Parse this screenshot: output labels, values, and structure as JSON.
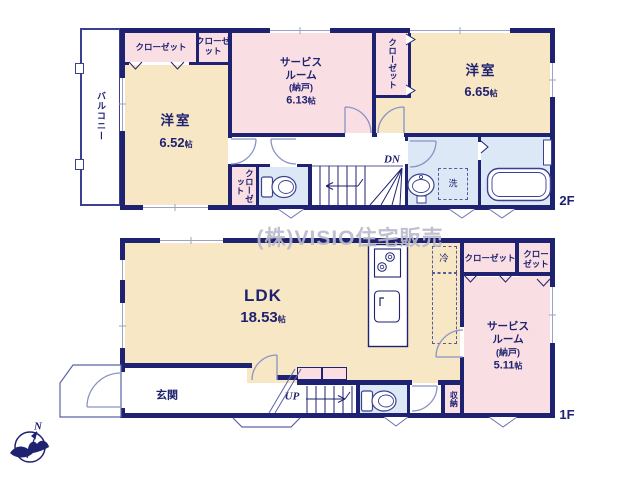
{
  "watermark": "(株)VISIO住宅販売",
  "compass": {
    "north": "N"
  },
  "colors": {
    "wall": "#1f2270",
    "room_yellow": "#f7e7c5",
    "room_pink": "#f9dfe3",
    "wet_area_blue": "#dce8f5",
    "door_arc": "#8a93c4",
    "watermark_gray": "#b8bacb"
  },
  "floor2": {
    "label": "2F",
    "balcony": "バルコニー",
    "closet_top_left": "クローゼット",
    "closet_top_small": "クローゼット",
    "closet_east_vertical": "クローゼット",
    "closet_hall_vertical": "クローゼット",
    "room_west": {
      "name": "洋室",
      "size_value": "6.52",
      "size_unit": "帖"
    },
    "service_room": {
      "line1": "サービス",
      "line2": "ルーム",
      "line3": "(納戸)",
      "size_value": "6.13",
      "size_unit": "帖"
    },
    "room_east": {
      "name": "洋室",
      "size_value": "6.65",
      "size_unit": "帖"
    },
    "stairs": "DN",
    "laundry": "洗"
  },
  "floor1": {
    "label": "1F",
    "ldk": {
      "name": "LDK",
      "size_value": "18.53",
      "size_unit": "帖"
    },
    "fridge": "冷",
    "closet_a": "クローゼット",
    "closet_b": "クローゼット",
    "service_room": {
      "line1": "サービス",
      "line2": "ルーム",
      "line3": "(納戸)",
      "size_value": "5.11",
      "size_unit": "帖"
    },
    "entrance": "玄関",
    "stairs": "UP",
    "storage": "収納"
  }
}
